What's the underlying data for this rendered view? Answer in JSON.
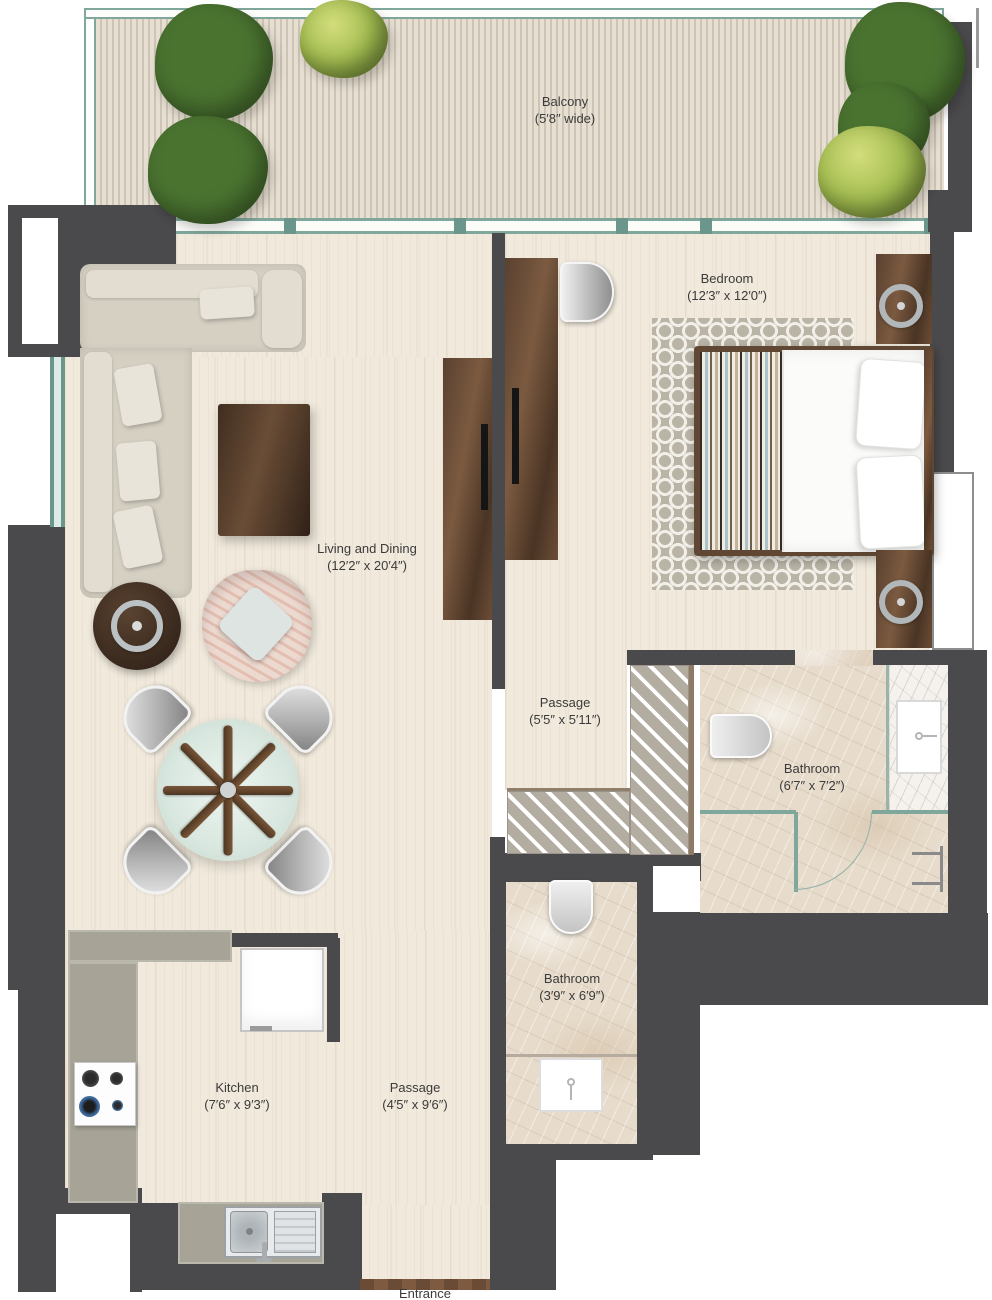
{
  "plan_title": "One-bedroom apartment floor plan",
  "rooms": {
    "balcony": {
      "name": "Balcony",
      "dims": "(5′8″ wide)"
    },
    "bedroom": {
      "name": "Bedroom",
      "dims": "(12′3″ x 12′0″)"
    },
    "living": {
      "name": "Living and Dining",
      "dims": "(12′2″ x 20′4″)"
    },
    "passage_upper": {
      "name": "Passage",
      "dims": "(5′5″ x 5′11″)"
    },
    "bathroom_main": {
      "name": "Bathroom",
      "dims": "(6′7″ x 7′2″)"
    },
    "bathroom_small": {
      "name": "Bathroom",
      "dims": "(3′9″ x 6′9″)"
    },
    "kitchen": {
      "name": "Kitchen",
      "dims": "(7′6″ x 9′3″)"
    },
    "passage_lower": {
      "name": "Passage",
      "dims": "(4′5″ x 9′6″)"
    },
    "entrance": {
      "name": "Entrance"
    }
  },
  "colors": {
    "wall": "#4a4a4c",
    "floor_wood": "#f0e9dc",
    "marble": "#e7dccb",
    "window_teal": "#6b968c",
    "counter": "#a7a497",
    "furniture_wood": "#5a4130",
    "plant_green": "#5d8a38",
    "plant_light_green": "#a3bd50"
  }
}
